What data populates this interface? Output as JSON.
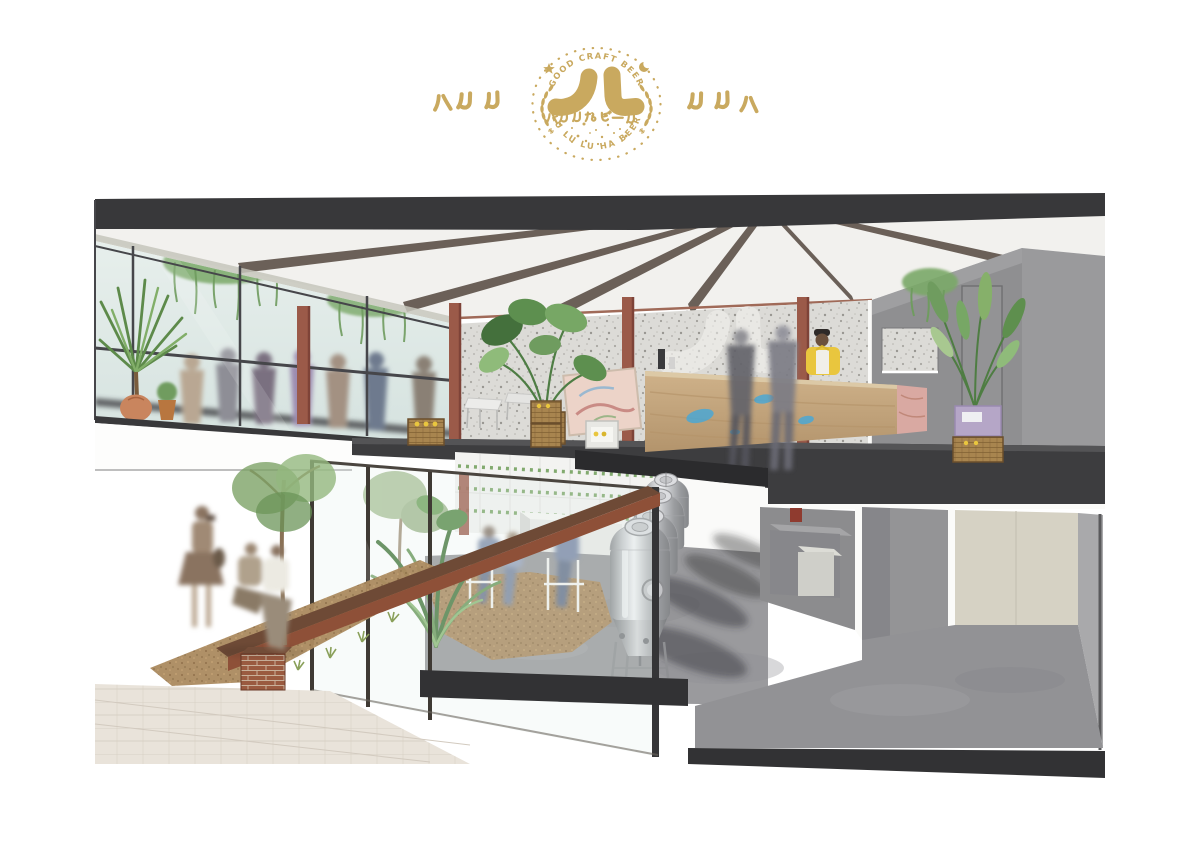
{
  "page": {
    "background": "#ffffff"
  },
  "logo": {
    "badge": {
      "arc_top": "GOOD CRAFT BEER",
      "arc_bottom": "LU LU LU HA BEER",
      "center_glyph": "ノム",
      "subtitle": "ハルルなビール",
      "color": "#c9a95f"
    },
    "side_left": "ハルル",
    "side_right": "ルルハ"
  },
  "illustration": {
    "alt": "Cutaway perspective rendering of a two-storey craft beer taproom: upstairs bar hall with speckled terrazzo wall, ghosted wall logo, red steel columns, glass facade with hanging plants and blurred patrons, stone-front bar counter with bartender and beer crates; downstairs courtyard garden with seated visitors, four stainless fermentation tanks, concrete gallery, brick bench and street tree outside",
    "palette": {
      "gold": "#c9a95f",
      "roof": "#38383a",
      "ceiling": "#f2f1ee",
      "beam": "#6b6058",
      "terrazzo": "#dcdbd7",
      "column_red": "#9b5a49",
      "glass": "#dfe9e7",
      "plant_green": "#6f9c5f",
      "floor_dark": "#3d3d3f",
      "concrete": "#97979a",
      "dirt": "#ab8a5f",
      "brick": "#95523a",
      "counter_tan": "#c4a37b",
      "paint_blue": "#45a8d9",
      "marble_pink": "#d9a9a2",
      "cream_wall": "#d6d2c4",
      "gray_wall": "#8f8f91",
      "steel": "#c7c8ca",
      "accent_yellow": "#e9c63e",
      "paving": "#e8e2da"
    }
  }
}
